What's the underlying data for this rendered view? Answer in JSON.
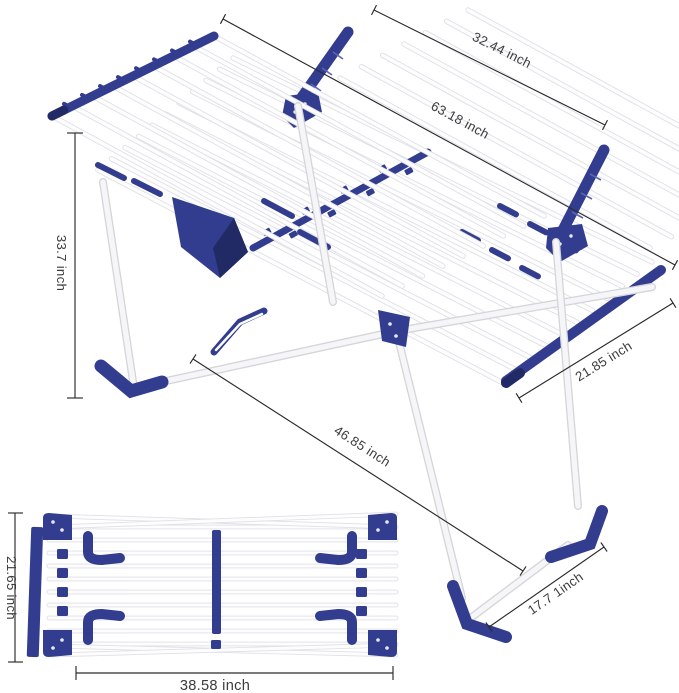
{
  "title": "clothes drying rack dimension diagram",
  "colors": {
    "navy": "#333d8f",
    "navy_dark": "#222a66",
    "rod_white": "#fdfdfe",
    "rod_shadow": "#dfe0e6",
    "dim_line": "#2b2b2b",
    "text": "#3c3c3c",
    "background": "#ffffff"
  },
  "dimensions": {
    "wing_width": {
      "label": "32.44 inch"
    },
    "total_length": {
      "label": "63.18 inch"
    },
    "open_height": {
      "label": "33.7 inch"
    },
    "deck_width": {
      "label": "21.85 inch"
    },
    "diagonal_length": {
      "label": "46.85 inch"
    },
    "leg_depth": {
      "label": "17.7 1inch"
    },
    "folded_width": {
      "label": "21.65 inch"
    },
    "folded_length": {
      "label": "38.58 inch"
    }
  },
  "figures": {
    "open_view": "gullwing drying rack, open, perspective view",
    "folded_view": "drying rack folded flat, top view"
  }
}
